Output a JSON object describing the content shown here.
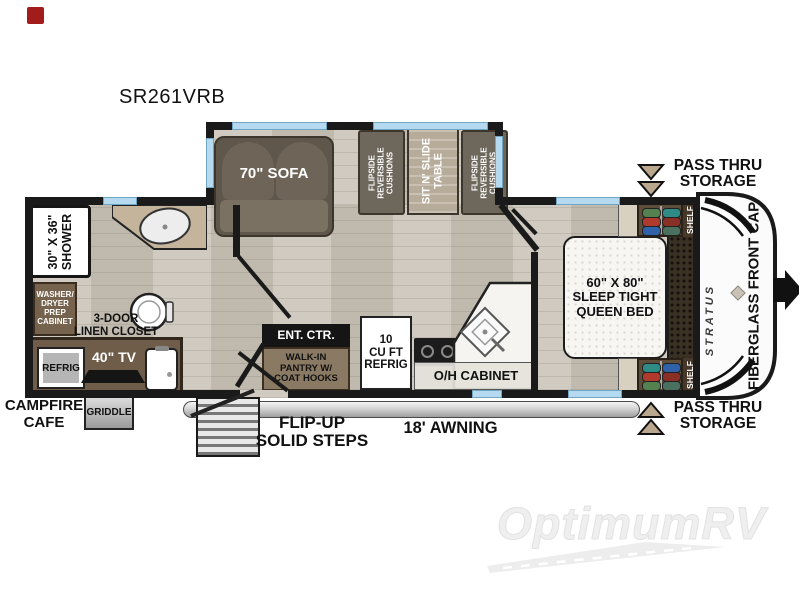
{
  "header": {
    "model": "SR261VRB"
  },
  "living_area": {
    "sofa_label": "70\" SOFA",
    "dinette": {
      "left_cushions": "FLIPSIDE\nREVERSIBLE\nCUSHIONS",
      "table": "SIT N' SLIDE\nTABLE",
      "right_cushions": "FLIPSIDE\nREVERSIBLE\nCUSHIONS"
    },
    "ent_ctr": "ENT. CTR.",
    "pantry": "WALK-IN\nPANTRY W/\nCOAT HOOKS",
    "refrigerator": "10\nCU FT\nREFRIG",
    "oh_cabinet": "O/H CABINET"
  },
  "bathroom": {
    "shower": "30\" X 36\"\nSHOWER",
    "washer_dryer_cabinet": "WASHER/\nDRYER\nPREP\nCABINET",
    "linen_closet": "3-DOOR\nLINEN CLOSET"
  },
  "campfire_cafe": {
    "label": "CAMPFIRE\nCAFE",
    "refrigerator": "REFRIG",
    "tv": "40\" TV",
    "griddle": "GRIDDLE"
  },
  "bedroom": {
    "bed": "60\" X 80\"\nSLEEP TIGHT\nQUEEN BED",
    "shelf_front_top": "SHELF",
    "shelf_front_bottom": "SHELF",
    "brand": "STRATUS",
    "front_cap": "FIBERGLASS FRONT CAP"
  },
  "exterior": {
    "pass_thru_storage_top": "PASS THRU\nSTORAGE",
    "pass_thru_storage_bottom": "PASS THRU\nSTORAGE",
    "awning": "18' AWNING",
    "steps": "FLIP-UP\nSOLID STEPS"
  },
  "watermark": "OptimumRV",
  "colors": {
    "wall": "#1a1a1a",
    "window": "#b5d9ef",
    "floor": "#c8c2b7",
    "cabinet_brown": "#75634d",
    "cushion": "#6e675c",
    "table_wood": "#b7ab99",
    "marker_red": "#a21c1c",
    "hanger_items": [
      "#55804f",
      "#b03a2e",
      "#2f62a8",
      "#2e8b85",
      "#8a2f26",
      "#4a7160"
    ]
  }
}
